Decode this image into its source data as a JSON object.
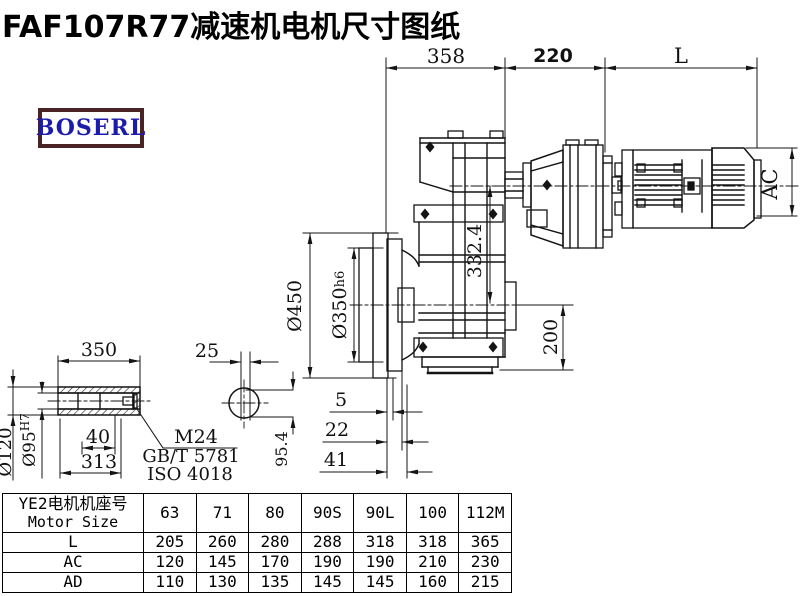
{
  "title": "FAF107R77减速机电机尺寸图纸",
  "logo": {
    "text": "BOSERL"
  },
  "dims": {
    "d358": "358",
    "d220": "220",
    "dL": "L",
    "dAC": "AC",
    "d332": "332.4",
    "d450": "Ø450",
    "d350": "Ø350",
    "d350s": "h6",
    "d200": "200",
    "s350": "350",
    "s25": "25",
    "d120": "Ø120",
    "d95": "Ø95",
    "d95s": "H7",
    "s40": "40",
    "s313": "313",
    "m24": "M24",
    "gb": "GB/T 5781",
    "iso": "ISO 4018",
    "d954": "95.4",
    "o5": "5",
    "o22": "22",
    "o41": "41"
  },
  "table": {
    "header_cn": "YE2电机机座号",
    "header_en": "Motor Size",
    "columns": [
      "63",
      "71",
      "80",
      "90S",
      "90L",
      "100",
      "112M"
    ],
    "rows": [
      {
        "label": "L",
        "values": [
          "205",
          "260",
          "280",
          "288",
          "318",
          "318",
          "365"
        ]
      },
      {
        "label": "AC",
        "values": [
          "120",
          "145",
          "170",
          "190",
          "190",
          "210",
          "230"
        ]
      },
      {
        "label": "AD",
        "values": [
          "110",
          "130",
          "135",
          "145",
          "145",
          "160",
          "215"
        ]
      }
    ]
  }
}
